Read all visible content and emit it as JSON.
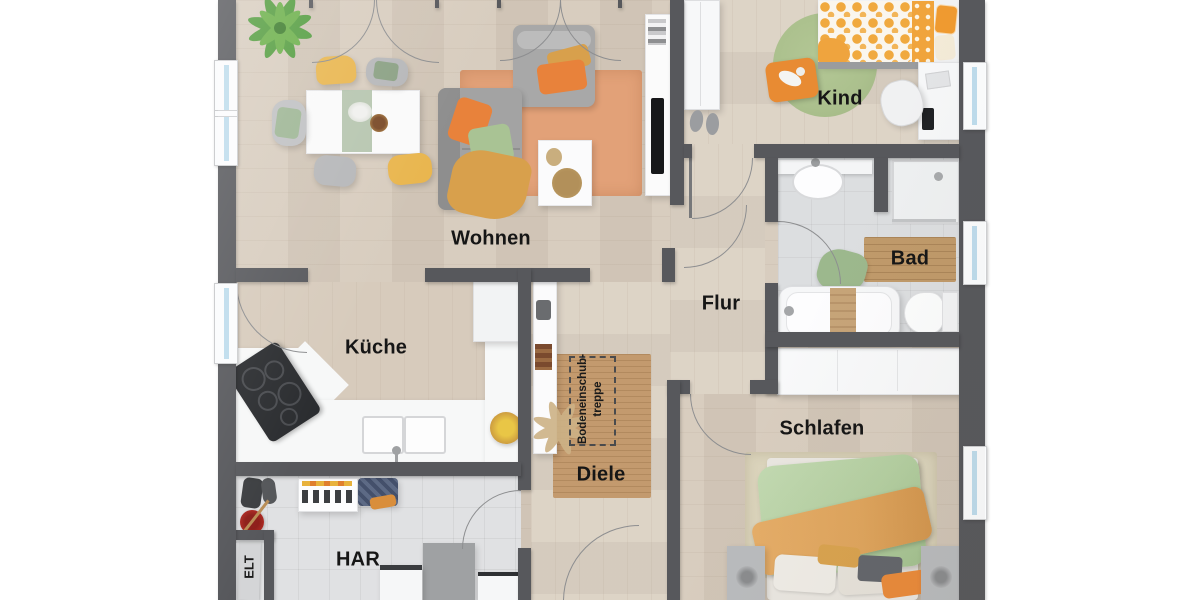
{
  "meta": {
    "type": "floor-plan-rendering",
    "style": "top-down 3D furnished plan"
  },
  "labels": {
    "wohnen": "Wohnen",
    "kueche": "Küche",
    "flur": "Flur",
    "kind": "Kind",
    "bad": "Bad",
    "schlafen": "Schlafen",
    "diele": "Diele",
    "har": "HAR",
    "elt": "ELT",
    "attic_line1": "Bodeneinschub-",
    "attic_line2": "treppe"
  },
  "palette": {
    "wall": "#57585c",
    "wood_floor": "#d6cabb",
    "wood_floor_light": "#dbd1c3",
    "tile_utility": "#e0e1e3",
    "tile_bath": "#dcdee0",
    "window_glass": "#bedcec",
    "rug_orange": "#e2a178",
    "rug_jute": "#c39a6e",
    "rug_green": "#abc08d",
    "rug_beige": "#dbd4bc",
    "accent_orange": "#e8823b",
    "accent_green": "#a9c394",
    "accent_mustard": "#d8a04c",
    "accent_yellow": "#e9b64f",
    "label_color": "#161616"
  }
}
